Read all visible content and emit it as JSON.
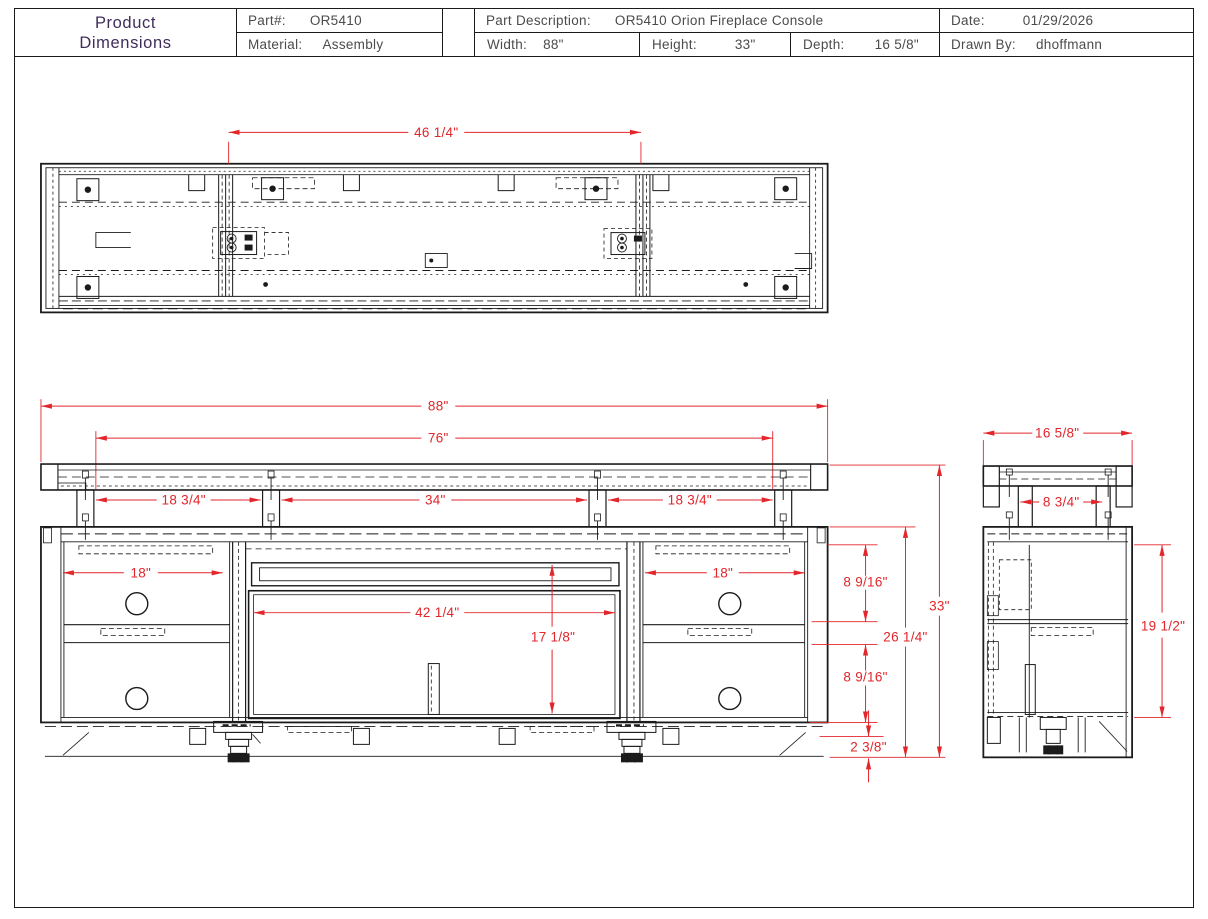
{
  "header": {
    "title_line1": "Product",
    "title_line2": "Dimensions",
    "part": {
      "label": "Part#:",
      "value": "OR5410"
    },
    "material": {
      "label": "Material:",
      "value": "Assembly"
    },
    "description": {
      "label": "Part Description:",
      "value": "OR5410 Orion Fireplace Console"
    },
    "width": {
      "label": "Width:",
      "value": "88\""
    },
    "height": {
      "label": "Height:",
      "value": "33\""
    },
    "depth": {
      "label": "Depth:",
      "value": "16 5/8\""
    },
    "date": {
      "label": "Date:",
      "value": "01/29/2026"
    },
    "drawn_by": {
      "label": "Drawn By:",
      "value": "dhoffmann"
    }
  },
  "colors": {
    "dimension_red": "#e2262b",
    "line_black": "#1b1b1b",
    "title_purple": "#402d5c"
  },
  "dims": {
    "top_opening_width": "46 1/4\"",
    "overall_width": "88\"",
    "top_board_width": "76\"",
    "left_riser_span": "18 3/4\"",
    "center_riser_span": "34\"",
    "drawer_width": "18\"",
    "fireplace_opening_width": "42 1/4\"",
    "fireplace_opening_height": "17 1/8\"",
    "drawer_opening_height": "8 9/16\"",
    "cabinet_height": "26 1/4\"",
    "overall_height": "33\"",
    "base_height": "2 3/8\"",
    "overall_depth": "16 5/8\"",
    "riser_depth_span": "8 3/4\"",
    "side_interior_height": "19 1/2\""
  }
}
